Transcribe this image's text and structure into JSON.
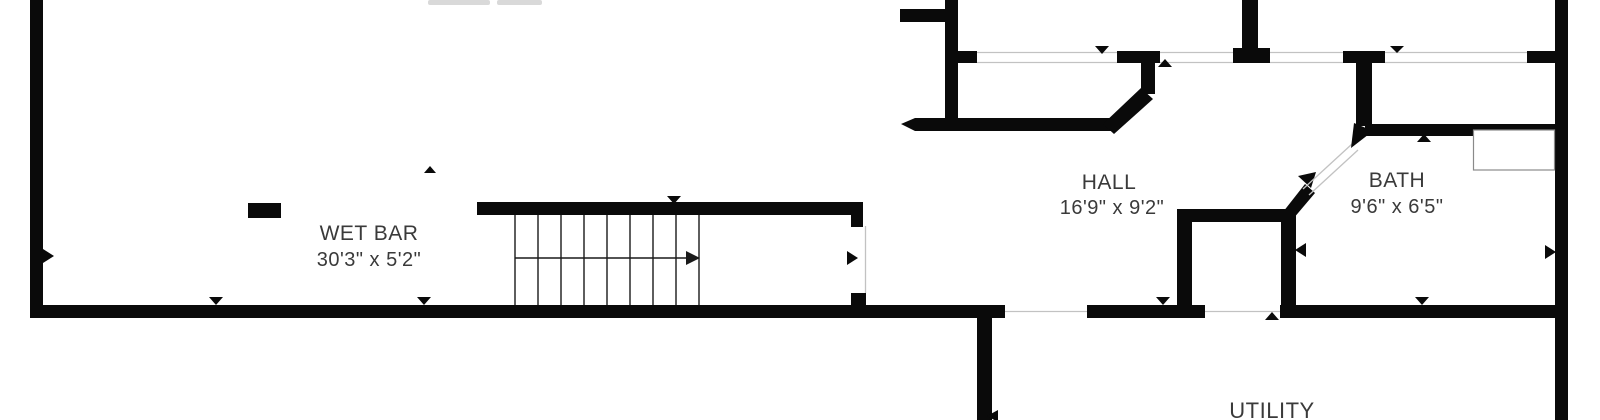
{
  "plan": {
    "type": "basement-floor-plan",
    "rooms": {
      "wet_bar": {
        "name": "WET BAR",
        "dims": "30'3\" x 5'2\""
      },
      "hall": {
        "name": "HALL",
        "dims": "16'9\" x 9'2\""
      },
      "bath": {
        "name": "BATH",
        "dims": "9'6\" x 6'5\""
      },
      "utility": {
        "name": "UTILITY"
      }
    },
    "colors": {
      "wall": "#0a0a0a",
      "opening_line": "#c2c2c2",
      "stair_line": "#1a1a1a",
      "text": "#3a3a3a",
      "background": "#ffffff",
      "cutoff_text": "#d9d9d9"
    }
  }
}
